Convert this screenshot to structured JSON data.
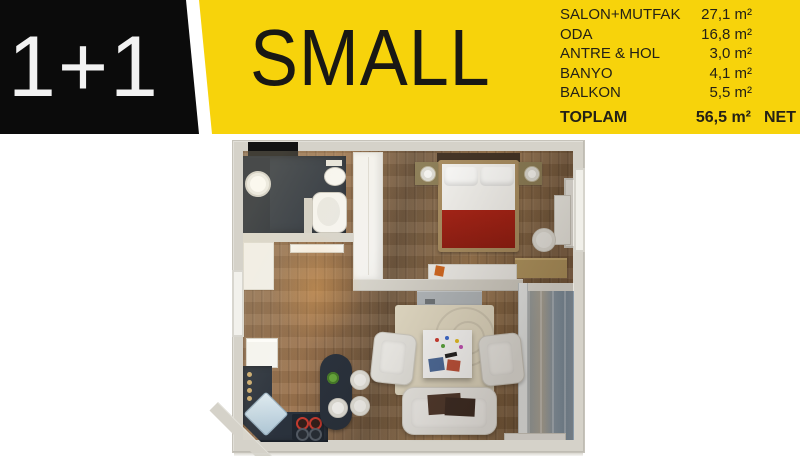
{
  "header": {
    "unit_type": "1+1",
    "plan_name": "SMALL",
    "areas": [
      {
        "label": "SALON+MUTFAK",
        "value": "27,1 m²"
      },
      {
        "label": "ODA",
        "value": "16,8 m²"
      },
      {
        "label": "ANTRE & HOL",
        "value": "3,0 m²"
      },
      {
        "label": "BANYO",
        "value": "4,1 m²"
      },
      {
        "label": "BALKON",
        "value": "5,5 m²"
      }
    ],
    "total": {
      "label": "TOPLAM",
      "value": "56,5 m²",
      "suffix": "NET"
    },
    "colors": {
      "banner_yellow": "#f7d30b",
      "box_black": "#0b0b0b",
      "text_dark": "#242116"
    }
  },
  "floor_plan": {
    "colors": {
      "wall": "#d5d2c9",
      "wood_floor": "#8a6647",
      "bathroom_floor": "#232b36",
      "kitchen_counter": "#222a35",
      "bed_blanket_red": "#9c1b10",
      "rug_beige": "#e4dcc5",
      "balcony_concrete": "#8d9dab"
    }
  }
}
